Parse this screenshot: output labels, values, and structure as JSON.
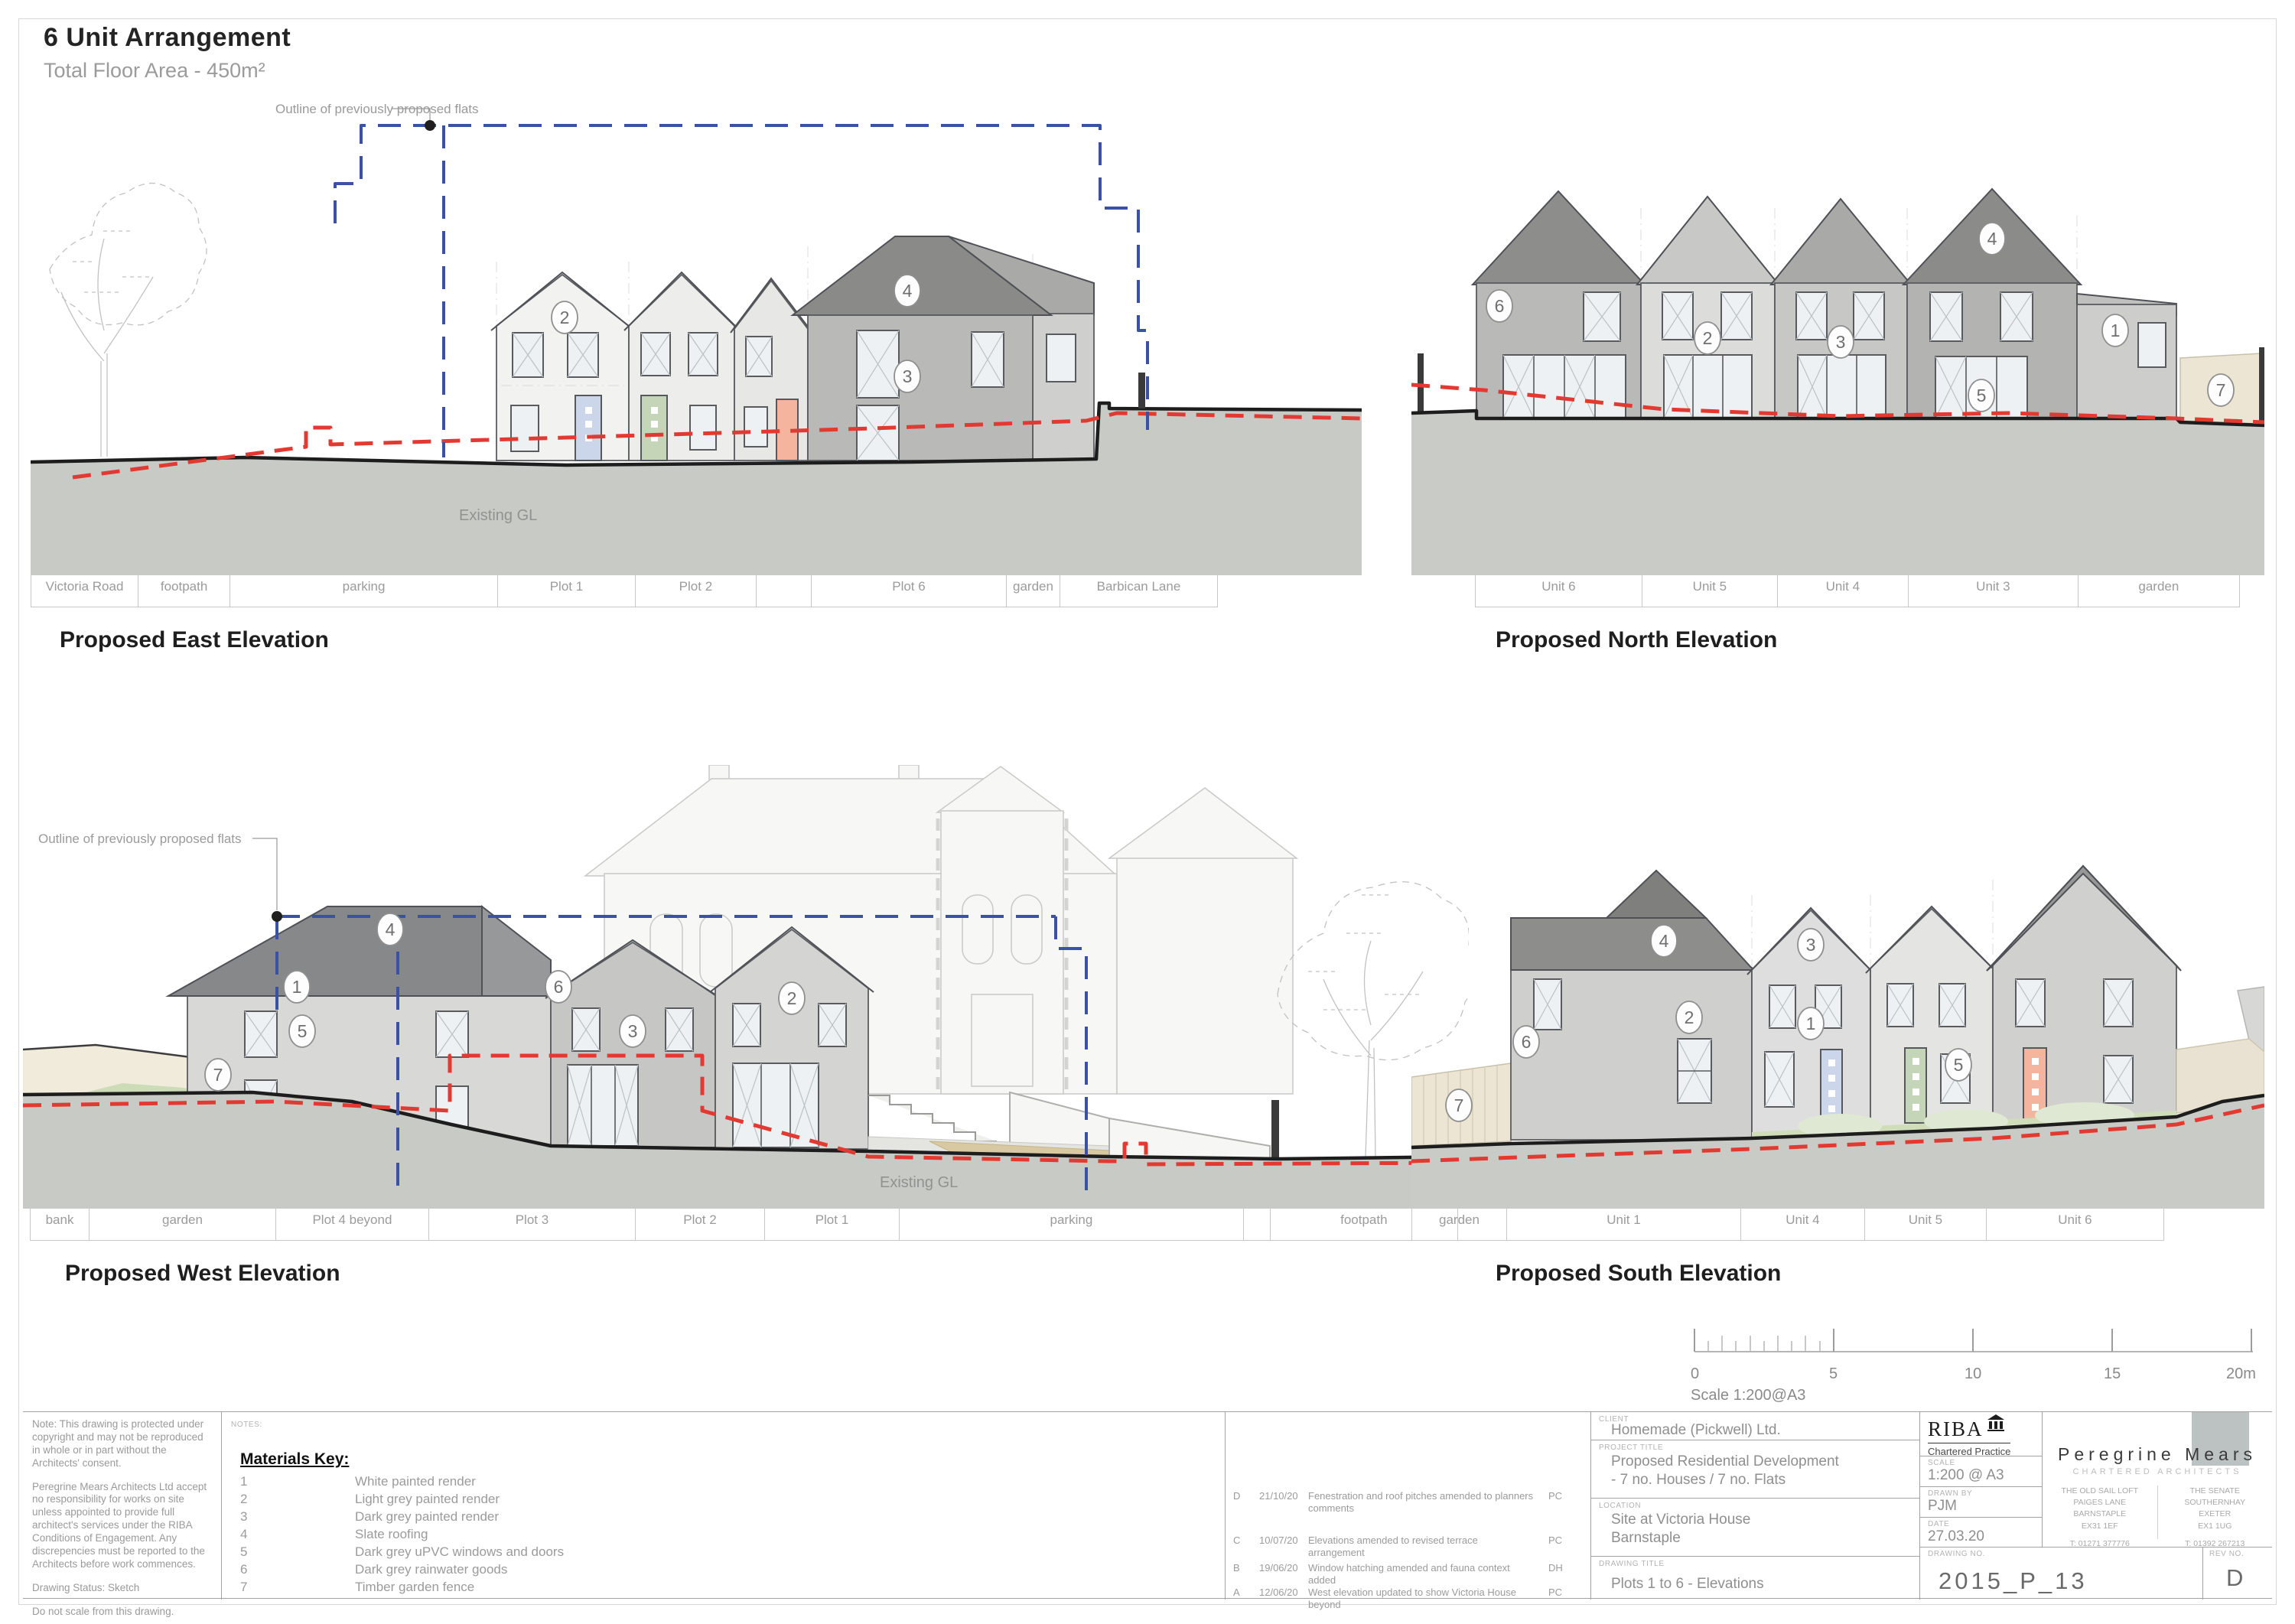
{
  "sheet": {
    "title": "6 Unit Arrangement",
    "subtitle": "Total Floor Area - 450m²"
  },
  "elevations": {
    "east": {
      "title": "Proposed East Elevation",
      "annotation": "Outline of previously proposed flats",
      "gl_label": "Existing GL",
      "zones": [
        "Victoria Road",
        "footpath",
        "parking",
        "Plot 1",
        "Plot 2",
        "Plot 6",
        "garden",
        "Barbican Lane"
      ],
      "markers": [
        "2",
        "4",
        "3"
      ]
    },
    "north": {
      "title": "Proposed North Elevation",
      "zones": [
        "Unit 6",
        "Unit 5",
        "Unit 4",
        "Unit 3",
        "garden"
      ],
      "markers": [
        "6",
        "2",
        "3",
        "4",
        "1",
        "5",
        "7"
      ]
    },
    "west": {
      "title": "Proposed West Elevation",
      "annotation": "Outline of previously proposed flats",
      "gl_label": "Existing GL",
      "zones": [
        "bank",
        "garden",
        "Plot 4 beyond",
        "Plot 3",
        "Plot 2",
        "Plot 1",
        "parking",
        "footpath"
      ],
      "markers": [
        "7",
        "4",
        "1",
        "5",
        "6",
        "3",
        "2"
      ]
    },
    "south": {
      "title": "Proposed South Elevation",
      "zones": [
        "garden",
        "Unit 1",
        "Unit 4",
        "Unit 5",
        "Unit 6"
      ],
      "markers": [
        "7",
        "6",
        "2",
        "4",
        "3",
        "1",
        "5"
      ]
    }
  },
  "scale_bar": {
    "ticks": [
      "0",
      "5",
      "10",
      "15",
      "20m"
    ],
    "label": "Scale 1:200@A3"
  },
  "title_block": {
    "copyright_notes": [
      "Note: This drawing is protected under copyright and may not be reproduced in whole or in part without the Architects' consent.",
      "Peregrine Mears Architects Ltd accept no responsibility for works on site unless appointed to provide full architect's services under the RIBA Conditions of Engagement. Any discrepencies must be reported to the Architects before work commences.",
      "Drawing Status: Sketch",
      "Do not scale from this drawing."
    ],
    "notes_label": "NOTES:",
    "materials_key": {
      "heading": "Materials Key:",
      "items": [
        {
          "num": "1",
          "desc": "White painted render"
        },
        {
          "num": "2",
          "desc": "Light grey painted render"
        },
        {
          "num": "3",
          "desc": "Dark grey painted render"
        },
        {
          "num": "4",
          "desc": "Slate roofing"
        },
        {
          "num": "5",
          "desc": "Dark grey uPVC windows and doors"
        },
        {
          "num": "6",
          "desc": "Dark grey rainwater goods"
        },
        {
          "num": "7",
          "desc": "Timber garden fence"
        }
      ]
    },
    "revisions": [
      {
        "rev": "D",
        "date": "21/10/20",
        "desc": "Fenestration and roof pitches amended to planners comments",
        "by": "PC"
      },
      {
        "rev": "C",
        "date": "10/07/20",
        "desc": "Elevations amended to revised terrace arrangement",
        "by": "PC"
      },
      {
        "rev": "B",
        "date": "19/06/20",
        "desc": "Window hatching amended and fauna context added",
        "by": "DH"
      },
      {
        "rev": "A",
        "date": "12/06/20",
        "desc": "West elevation updated to show Victoria House beyond",
        "by": "PC"
      }
    ],
    "client": {
      "label": "CLIENT",
      "name": "Homemade (Pickwell) Ltd."
    },
    "project": {
      "label": "PROJECT TITLE",
      "line1": "Proposed Residential Development",
      "line2": "- 7 no. Houses / 7 no. Flats"
    },
    "location": {
      "label": "LOCATION",
      "line1": "Site at Victoria House",
      "line2": "Barnstaple"
    },
    "drawing_title": {
      "label": "DRAWING TITLE",
      "value": "Plots 1 to 6 - Elevations"
    },
    "riba": {
      "name": "RIBA",
      "tagline": "Chartered Practice"
    },
    "scale": {
      "label": "SCALE",
      "value": "1:200 @ A3"
    },
    "drawn_by": {
      "label": "DRAWN BY",
      "value": "PJM"
    },
    "date": {
      "label": "DATE",
      "value": "27.03.20"
    },
    "drawing_no": {
      "label": "DRAWING NO.",
      "value": "2015_P_13"
    },
    "rev_no": {
      "label": "REV NO.",
      "value": "D"
    },
    "firm": {
      "name": "Peregrine Mears",
      "tagline": "CHARTERED ARCHITECTS",
      "office_barnstaple": {
        "lines": [
          "THE OLD SAIL LOFT",
          "PAIGES LANE",
          "BARNSTAPLE",
          "EX31 1EF"
        ],
        "tel": "T: 01271 377776"
      },
      "office_exeter": {
        "lines": [
          "THE SENATE",
          "SOUTHERNHAY",
          "EXETER",
          "EX1 1UG"
        ],
        "tel": "T: 01392 267213"
      }
    }
  },
  "colors": {
    "red_gl": "#e23a33",
    "blue_outline": "#3b51a3",
    "ground": "#c7cac5",
    "roof_dark": "#8a8b89",
    "door_blue": "#ccd6ea",
    "door_green": "#c5d6b8",
    "door_salmon": "#f4b49e",
    "fence_beige": "#ede5d3"
  }
}
